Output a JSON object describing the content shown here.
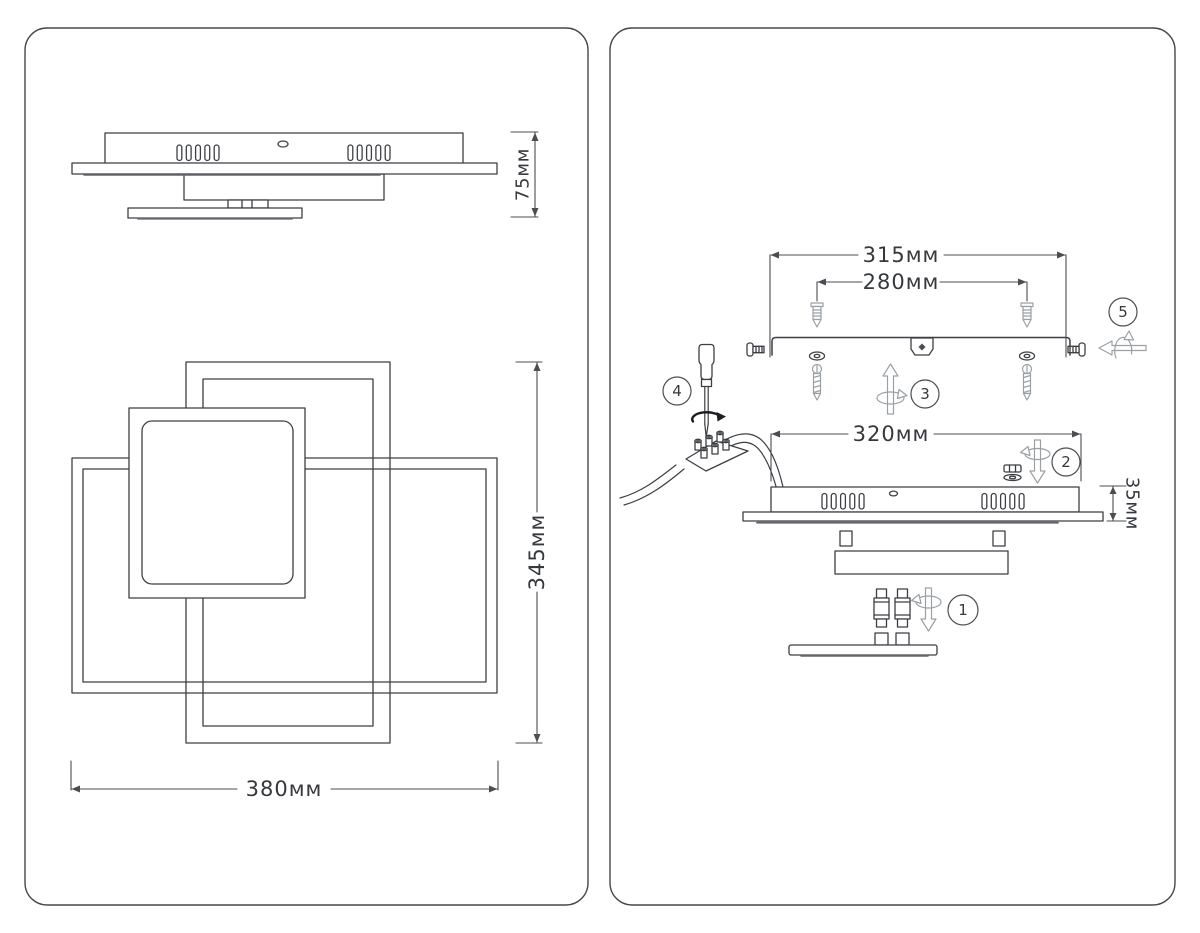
{
  "page": {
    "background": "#ffffff",
    "line_color": "#3c3f43",
    "hardware_color": "#9ba0a5"
  },
  "left_panel": {
    "side_view_height": "75мм",
    "front_view_height": "345мм",
    "front_view_width": "380мм"
  },
  "right_panel": {
    "bracket_length": "315мм",
    "anchor_spacing": "280мм",
    "base_length": "320мм",
    "base_height": "35мм",
    "steps": [
      "1",
      "2",
      "3",
      "4",
      "5"
    ]
  }
}
